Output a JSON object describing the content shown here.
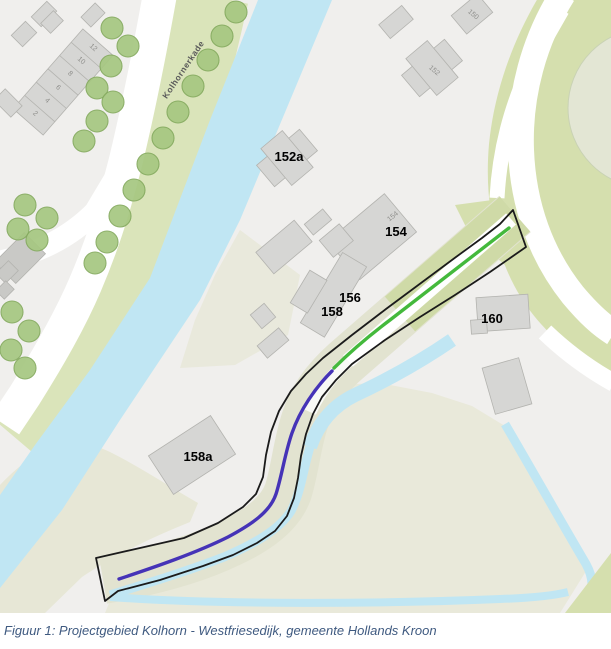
{
  "figure": {
    "caption": "Figuur 1: Projectgebied Kolhorn - Westfriesedijk, gemeente Hollands Kroon"
  },
  "map": {
    "street_label": "Kolhornerkade",
    "building_labels": {
      "b152a": "152a",
      "b154": "154",
      "b156": "156",
      "b158": "158",
      "b160": "160",
      "b158a": "158a"
    },
    "unit_numbers": {
      "u2": "2",
      "u4": "4",
      "u6": "6",
      "u8": "8",
      "u10": "10",
      "u12": "12",
      "u150": "150",
      "u152": "152",
      "u154": "154"
    },
    "colors": {
      "base": "#f0efed",
      "building": "#d6d6d4",
      "building_dark": "#c9c9c6",
      "building_edge": "#b3b3af",
      "road": "#ffffff",
      "water": "#c0e6f3",
      "vegetation": "#d5dfae",
      "verge": "#dae4ba",
      "olive": "#e7e7d6",
      "field": "#e9e9da",
      "band": "#e2e3d0",
      "band_green": "#cfdaa7",
      "corner": "#e3e6d4",
      "boundary": "#1b1b1b",
      "trace_green": "#44b93c",
      "trace_blue": "#4533b7",
      "tree": "#a6c781",
      "tree_edge": "#84aa5e",
      "label": "#000000",
      "unit": "#8e8e8b",
      "street": "#5a5a5a",
      "caption": "#3f5a80"
    }
  }
}
